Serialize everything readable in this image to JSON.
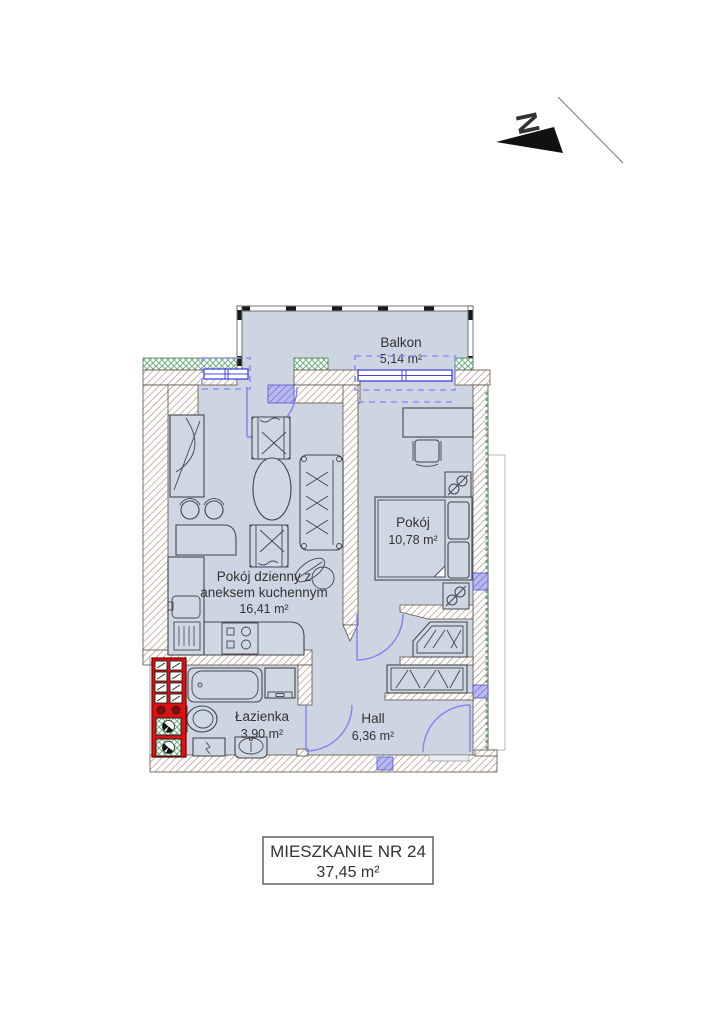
{
  "drawing": {
    "type": "apartment-floor-plan",
    "north": {
      "label": "N"
    },
    "title_block": {
      "line1": "MIESZKANIE NR 24",
      "line2": "37,45 m²"
    },
    "rooms": {
      "balkon": {
        "name": "Balkon",
        "area": "5,14 m²"
      },
      "pokoj": {
        "name": "Pokój",
        "area": "10,78 m²"
      },
      "living": {
        "name_line1": "Pokój dzienny z",
        "name_line2": "aneksem kuchennym",
        "area": "16,41 m²"
      },
      "lazienka": {
        "name": "Łazienka",
        "area": "3,90 m²"
      },
      "hall": {
        "name": "Hall",
        "area": "6,36 m²"
      }
    },
    "colors": {
      "floor_fill": "#cdd5e2",
      "wall_hatch": "#a08673",
      "insulation_green": "#6fae7e",
      "window_blue": "#4444dd",
      "door_arc_blue": "#8282f2",
      "shaft_red": "#dd1111",
      "lintel_blue": "#b8b8f0"
    }
  }
}
